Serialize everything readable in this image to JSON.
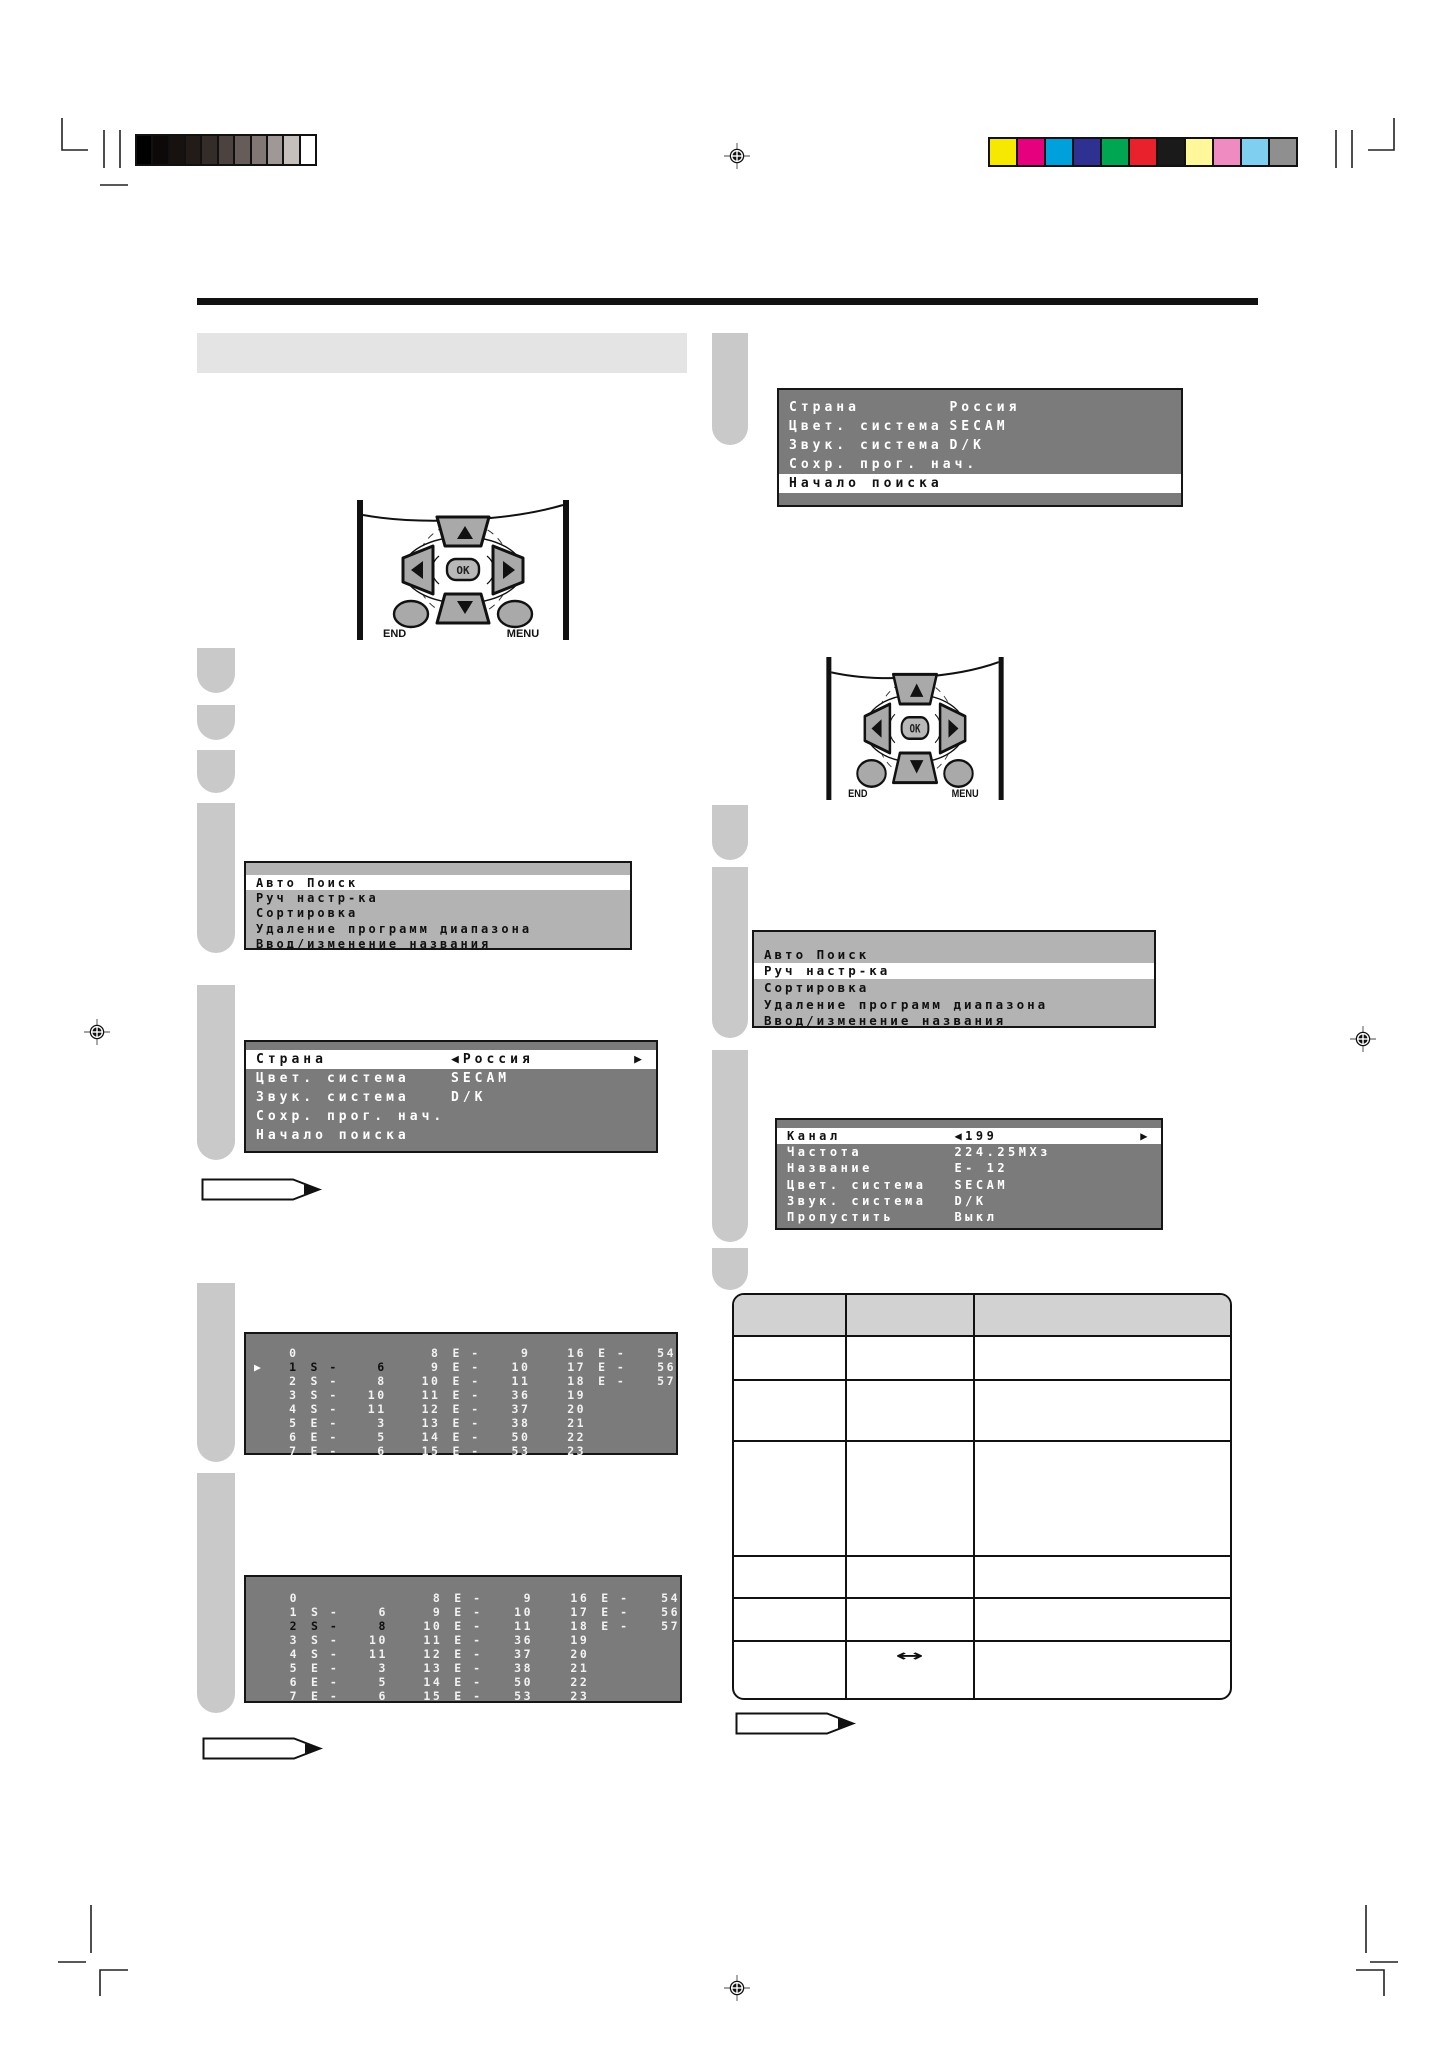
{
  "icons": {
    "cursor": "▶",
    "left_arrow": "◀",
    "right_arrow": "▶",
    "up_arrow": "▲",
    "down_arrow": "▼"
  },
  "calibration": {
    "grayscale": [
      "#000000",
      "#0c0908",
      "#171110",
      "#231b18",
      "#342c29",
      "#4c4240",
      "#665c59",
      "#817875",
      "#a09896",
      "#c6c0bd",
      "#ffffff"
    ],
    "colors": [
      "#f7e800",
      "#e6007e",
      "#00a0dd",
      "#2e3192",
      "#00a651",
      "#e8212d",
      "#1a1a1a",
      "#fff799",
      "#f08bc2",
      "#7fd0f0",
      "#8f8f8f"
    ]
  },
  "remote": {
    "ok": "OK",
    "end": "END",
    "menu": "MENU"
  },
  "screens": {
    "search_start": {
      "rows": [
        {
          "label": "Страна",
          "value": "Россия"
        },
        {
          "label": "Цвет. система",
          "value": "SECAM"
        },
        {
          "label": "Звук. система",
          "value": "D/K"
        },
        {
          "label": "Сохр. прог. нач.",
          "value": ""
        },
        {
          "label": "Начало поиска",
          "value": "",
          "highlight": true
        }
      ]
    },
    "main_menu_left": {
      "rows": [
        {
          "spacer": true
        },
        {
          "label": "Авто Поиск",
          "highlight": true
        },
        {
          "label": "Руч настр-ка"
        },
        {
          "label": "Сортировка"
        },
        {
          "label": "Удаление программ диапазона"
        },
        {
          "label": "Ввод/изменение названия"
        }
      ]
    },
    "country_select": {
      "rows": [
        {
          "label": "Страна",
          "value": "Россия",
          "arrows": true,
          "highlight": true
        },
        {
          "label": "Цвет. система",
          "value": "SECAM"
        },
        {
          "label": "Звук. система",
          "value": "D/K"
        },
        {
          "label": "Сохр. прог. нач.",
          "value": ""
        },
        {
          "label": "Начало поиска",
          "value": ""
        }
      ]
    },
    "main_menu_right": {
      "rows": [
        {
          "spacer": true
        },
        {
          "label": "Авто Поиск"
        },
        {
          "label": "Руч настр-ка",
          "highlight": true
        },
        {
          "label": "Сортировка"
        },
        {
          "label": "Удаление программ диапазона"
        },
        {
          "label": "Ввод/изменение названия"
        }
      ]
    },
    "manual_tune": {
      "rows": [
        {
          "label": "Канал",
          "value": "199",
          "arrows": true,
          "highlight": true
        },
        {
          "label": "Частота",
          "value": "224.25МХз"
        },
        {
          "label": "Название",
          "value": "E- 12"
        },
        {
          "label": "Цвет. система",
          "value": "SECAM"
        },
        {
          "label": "Звук. система",
          "value": "D/K"
        },
        {
          "label": "Пропустить",
          "value": "Выкл"
        }
      ]
    },
    "channel_grid_1": {
      "cursor_row": 1,
      "selected_row": 1,
      "rows": [
        [
          "0",
          "",
          "",
          "8",
          "E -",
          "9",
          "16",
          "E -",
          "54"
        ],
        [
          "1",
          "S -",
          "6",
          "9",
          "E -",
          "10",
          "17",
          "E -",
          "56"
        ],
        [
          "2",
          "S -",
          "8",
          "10",
          "E -",
          "11",
          "18",
          "E -",
          "57"
        ],
        [
          "3",
          "S -",
          "10",
          "11",
          "E -",
          "36",
          "19",
          "",
          ""
        ],
        [
          "4",
          "S -",
          "11",
          "12",
          "E -",
          "37",
          "20",
          "",
          ""
        ],
        [
          "5",
          "E -",
          "3",
          "13",
          "E -",
          "38",
          "21",
          "",
          ""
        ],
        [
          "6",
          "E -",
          "5",
          "14",
          "E -",
          "50",
          "22",
          "",
          ""
        ],
        [
          "7",
          "E -",
          "6",
          "15",
          "E -",
          "53",
          "23",
          "",
          ""
        ]
      ]
    },
    "channel_grid_2": {
      "cursor_row": null,
      "selected_row": 2,
      "rows": [
        [
          "0",
          "",
          "",
          "8",
          "E -",
          "9",
          "16",
          "E -",
          "54"
        ],
        [
          "1",
          "S -",
          "6",
          "9",
          "E -",
          "10",
          "17",
          "E -",
          "56"
        ],
        [
          "2",
          "S -",
          "8",
          "10",
          "E -",
          "11",
          "18",
          "E -",
          "57"
        ],
        [
          "3",
          "S -",
          "10",
          "11",
          "E -",
          "36",
          "19",
          "",
          ""
        ],
        [
          "4",
          "S -",
          "11",
          "12",
          "E -",
          "37",
          "20",
          "",
          ""
        ],
        [
          "5",
          "E -",
          "3",
          "13",
          "E -",
          "38",
          "21",
          "",
          ""
        ],
        [
          "6",
          "E -",
          "5",
          "14",
          "E -",
          "50",
          "22",
          "",
          ""
        ],
        [
          "7",
          "E -",
          "6",
          "15",
          "E -",
          "53",
          "23",
          "",
          ""
        ]
      ]
    }
  },
  "table": {
    "double_arrow": "↔"
  }
}
